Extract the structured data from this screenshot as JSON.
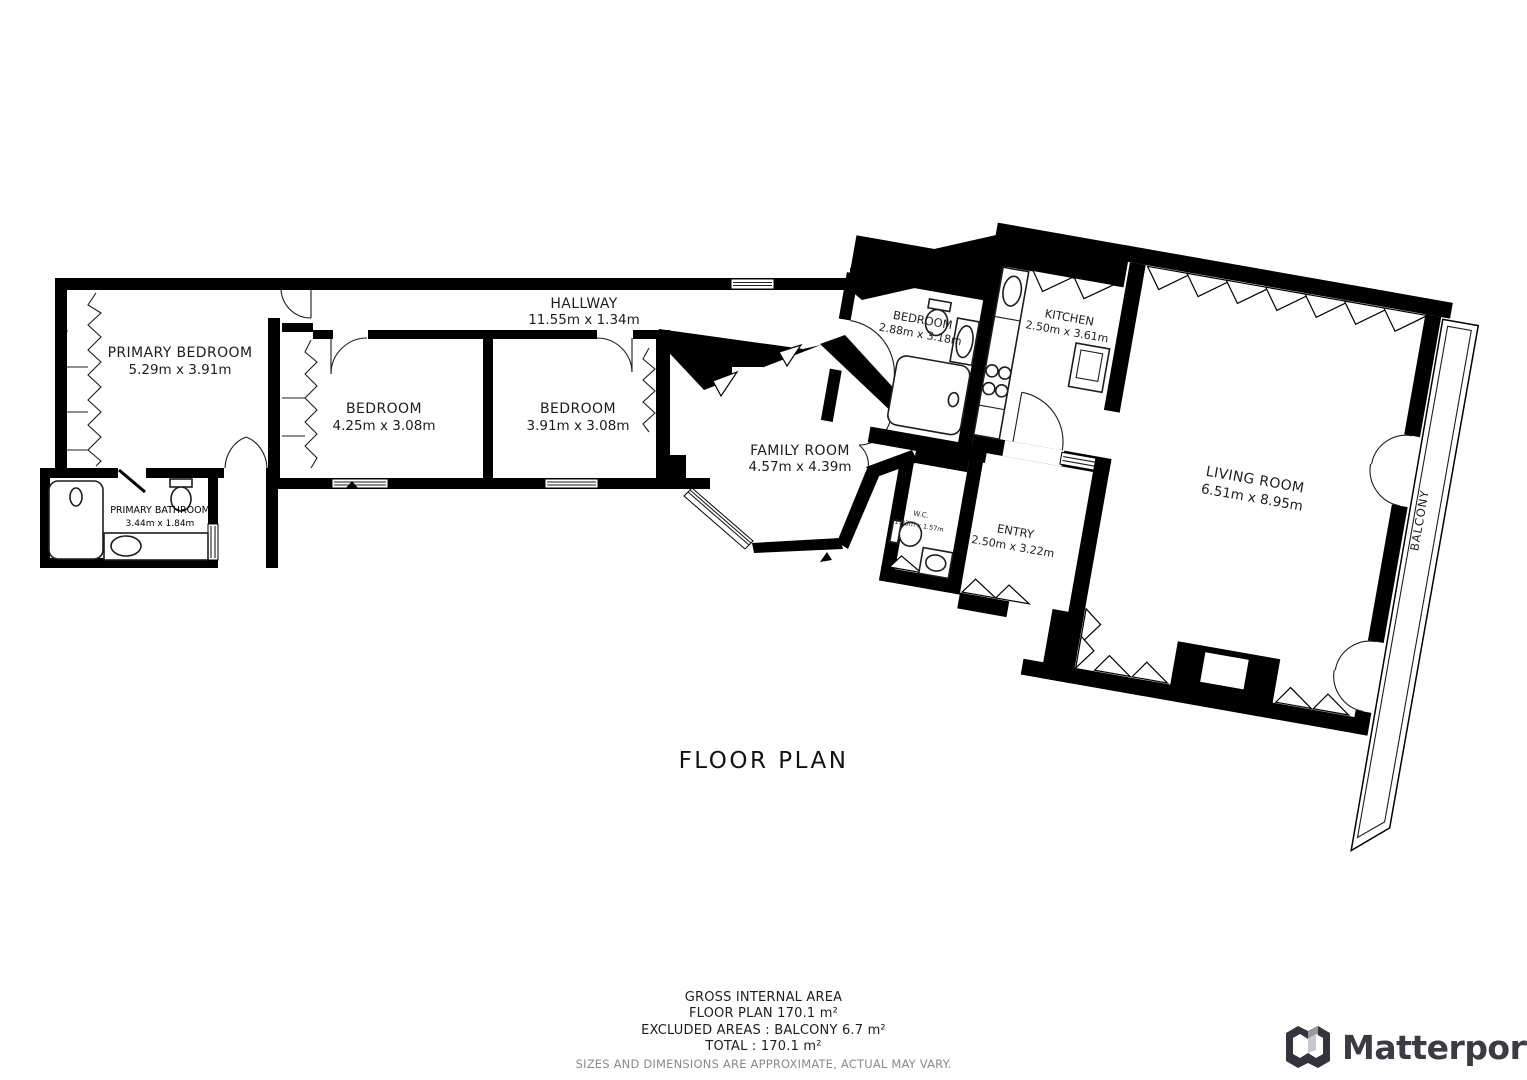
{
  "title": "FLOOR PLAN",
  "rooms": [
    {
      "name": "PRIMARY BEDROOM",
      "dims": "5.29m x 3.91m"
    },
    {
      "name": "PRIMARY BATHROOM",
      "dims": "3.44m x 1.84m"
    },
    {
      "name": "BEDROOM",
      "dims": "4.25m x 3.08m"
    },
    {
      "name": "BEDROOM",
      "dims": "3.91m x 3.08m"
    },
    {
      "name": "HALLWAY",
      "dims": "11.55m x 1.34m"
    },
    {
      "name": "FAMILY ROOM",
      "dims": "4.57m x 4.39m"
    },
    {
      "name": "BEDROOM",
      "dims": "2.88m x 3.18m"
    },
    {
      "name": "KITCHEN",
      "dims": "2.50m x 3.61m"
    },
    {
      "name": "LIVING ROOM",
      "dims": "6.51m x 8.95m"
    },
    {
      "name": "W.C.",
      "dims": "1.93m x 1.57m"
    },
    {
      "name": "ENTRY",
      "dims": "2.50m x 3.22m"
    },
    {
      "name": "BALCONY"
    }
  ],
  "summary": {
    "gross_internal_area_label": "GROSS INTERNAL AREA",
    "floor_plan_area": "FLOOR PLAN 170.1 m²",
    "excluded_areas": "EXCLUDED AREAS :  BALCONY 6.7 m²",
    "total": "TOTAL :  170.1 m²",
    "disclaimer": "SIZES AND DIMENSIONS ARE APPROXIMATE, ACTUAL MAY VARY."
  },
  "brand": {
    "wordmark": "Matterport"
  },
  "colors": {
    "wall": "#000000",
    "text": "#1d1d1d",
    "muted": "#8a8a8a",
    "brand": "#3b3b43"
  }
}
